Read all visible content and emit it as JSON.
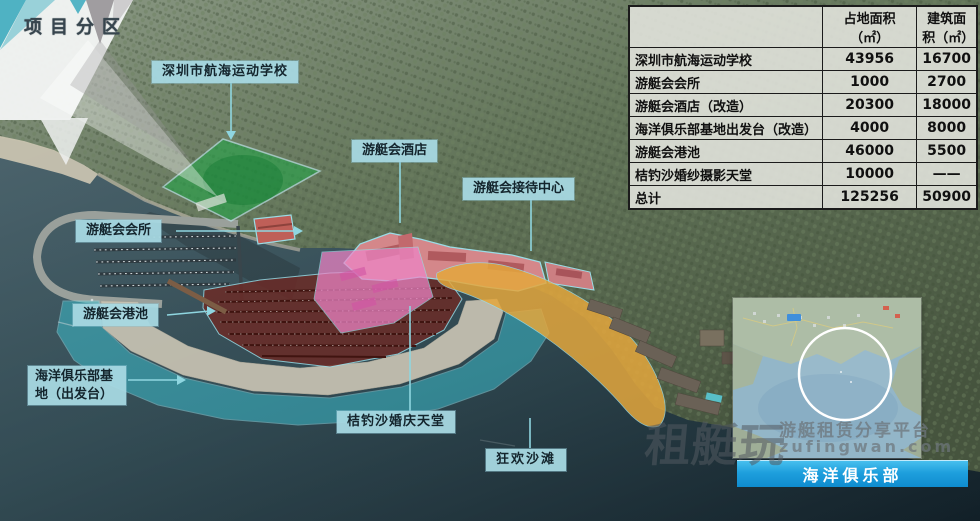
{
  "title": "项目分区",
  "map_labels": {
    "school": "深圳市航海运动学校",
    "hotel": "游艇会酒店",
    "reception": "游艇会接待中心",
    "club": "游艇会会所",
    "port": "游艇会港池",
    "base": "海洋俱乐部基地（出发台）",
    "wedding": "桔钓沙婚庆天堂",
    "beach": "狂欢沙滩"
  },
  "table": {
    "col_land": "占地面积（㎡）",
    "col_built": "建筑面积（㎡）",
    "rows": [
      {
        "name": "深圳市航海运动学校",
        "land": "43956",
        "built": "16700"
      },
      {
        "name": "游艇会会所",
        "land": "1000",
        "built": "2700"
      },
      {
        "name": "游艇会酒店（改造）",
        "land": "20300",
        "built": "18000"
      },
      {
        "name": "海洋俱乐部基地出发台（改造）",
        "land": "4000",
        "built": "8000"
      },
      {
        "name": "游艇会港池",
        "land": "46000",
        "built": "5500"
      },
      {
        "name": "桔钓沙婚纱摄影天堂",
        "land": "10000",
        "built": "——"
      },
      {
        "name": "总计",
        "land": "125256",
        "built": "50900"
      }
    ]
  },
  "inset": {
    "label": "海洋俱乐部"
  },
  "watermark": {
    "brand": "租艇玩",
    "tagline": "游艇租赁分享平台",
    "domain": "zufingwan.com"
  },
  "colors": {
    "label_bg": "#a7d8e2",
    "banner_blue": "#1e9fdd",
    "overlay_green": "#2aa24b",
    "overlay_pink": "#ee85c7",
    "overlay_maroon": "#6d2a25",
    "overlay_teal": "#3cc6d6",
    "beach_orange": "#e4a73d"
  }
}
